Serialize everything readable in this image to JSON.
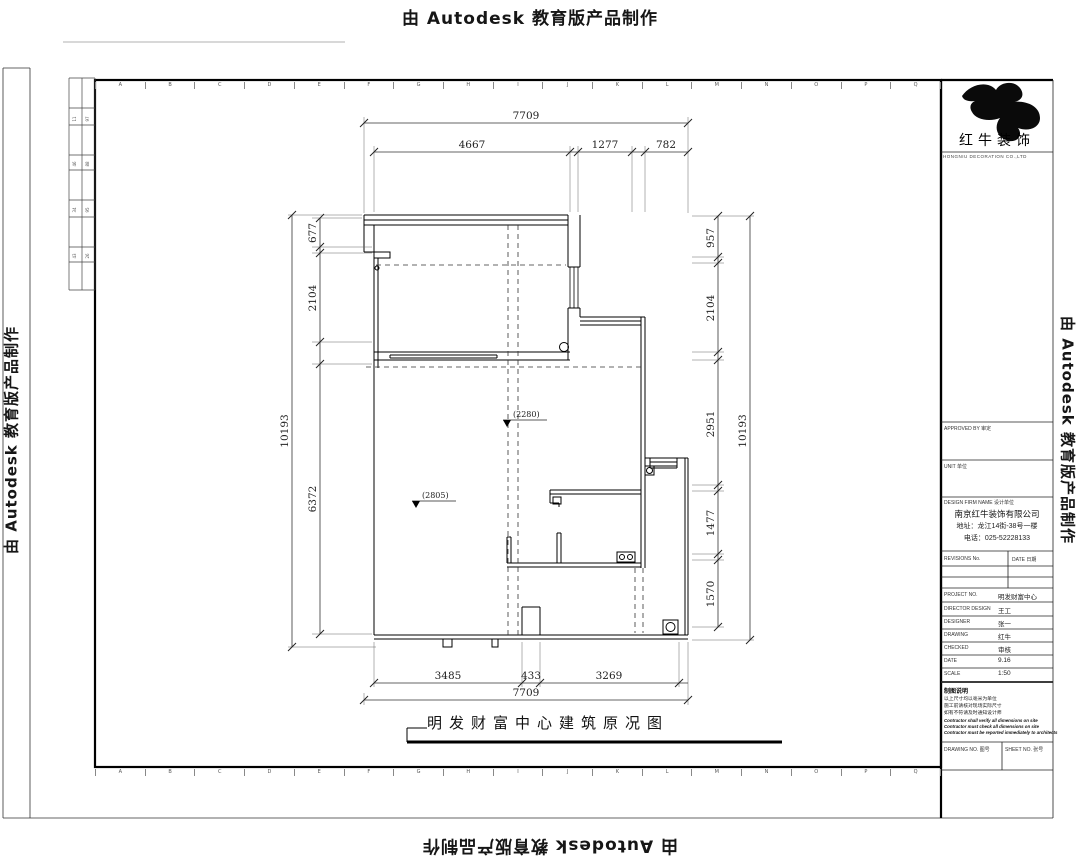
{
  "watermark": {
    "text": "由 Autodesk 教育版产品制作"
  },
  "plan": {
    "title": "明发财富中心建筑原况图",
    "dims": {
      "top_overall": "7709",
      "top": [
        "4667",
        "1277",
        "782"
      ],
      "bottom": [
        "3485",
        "433",
        "3269"
      ],
      "bottom_overall": "7709",
      "left_overall": "10193",
      "left": [
        "677",
        "2104",
        "6372"
      ],
      "right": [
        "957",
        "2104",
        "2951",
        "1477",
        "1570"
      ],
      "right_overall": "10193"
    },
    "levels": [
      "(2280)",
      "(2805)"
    ]
  },
  "title_block": {
    "brand": "红牛装饰",
    "brand_sub": "HONGNIU DECORATION CO.,LTD",
    "approved_label": "APPROVED BY 审定",
    "unit_label": "UNIT 单位",
    "firm_label": "DESIGN FIRM NAME 设计单位",
    "firm_name": "南京红牛装饰有限公司",
    "firm_address": "地址：龙江14街-38号一楼",
    "firm_phone": "电话：025-52228133",
    "revisions_label": "REVISIONS No.",
    "date_label": "DATE 日期",
    "rows": [
      {
        "label": "PROJECT NO.",
        "value": "明发财富中心"
      },
      {
        "label": "DIRECTOR DESIGN",
        "value": "王工"
      },
      {
        "label": "DESIGNER",
        "value": "张一"
      },
      {
        "label": "DRAWING",
        "value": "红牛"
      },
      {
        "label": "CHECKED",
        "value": "审核"
      },
      {
        "label": "DATE",
        "value": "9.16"
      },
      {
        "label": "SCALE",
        "value": "1:50"
      }
    ],
    "notes_title": "制图说明",
    "notes_cn": [
      "以上尺寸均以毫米为单位",
      "施工前请核对现场实际尺寸",
      "如有不符请及时通知设计师"
    ],
    "notes_en": [
      "Contractor shall verify all dimensions on site",
      "Contractor must check all dimensions on site",
      "Contractor must be reported immediately to architects"
    ],
    "drawing_no_label": "DRAWING NO. 图号",
    "sheet_no_label": "SHEET NO. 张号"
  },
  "ruler": {
    "letters_top": [
      "A",
      "B",
      "C",
      "D",
      "E",
      "F",
      "G",
      "H",
      "I",
      "J",
      "K",
      "L",
      "M",
      "N",
      "O",
      "P",
      "Q"
    ],
    "letters_bottom": [
      "A",
      "B",
      "C",
      "D",
      "E",
      "F",
      "G",
      "H",
      "I",
      "J",
      "K",
      "L",
      "M",
      "N",
      "O",
      "P",
      "Q"
    ]
  },
  "side_table": {
    "cells": [
      "11",
      "97",
      "46",
      "88",
      "34",
      "95",
      "43",
      "26"
    ]
  }
}
